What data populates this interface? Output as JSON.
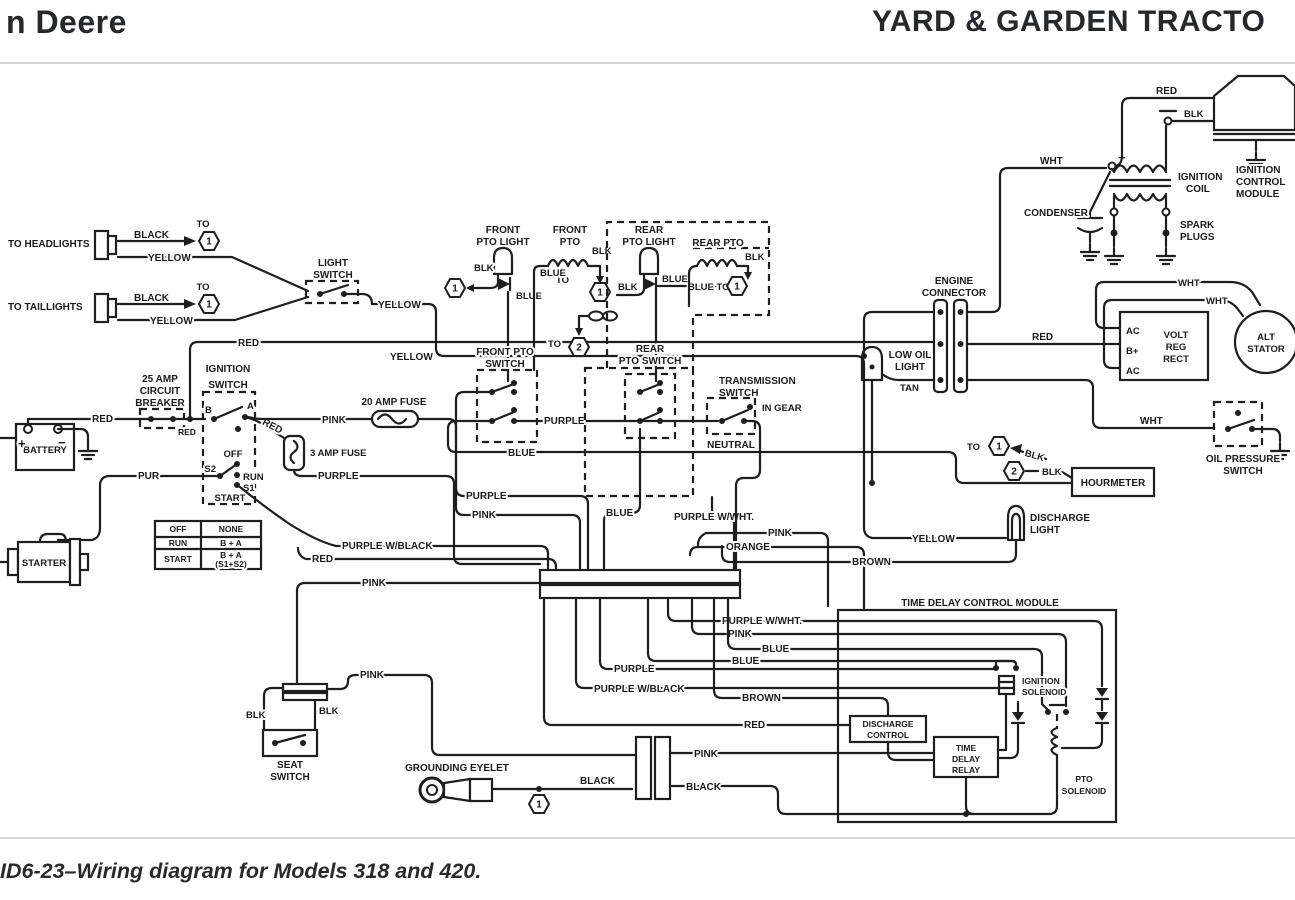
{
  "header": {
    "brand": "n Deere",
    "title": "YARD & GARDEN TRACTO"
  },
  "caption": "ID6-23–Wiring diagram for Models 318 and 420.",
  "wire": {
    "red": "RED",
    "black": "BLACK",
    "blk": "BLK",
    "yellow": "YELLOW",
    "blue": "BLUE",
    "purple": "PURPLE",
    "pink": "PINK",
    "pur": "PUR",
    "orange": "ORANGE",
    "brown": "BROWN",
    "tan": "TAN",
    "wht": "WHT",
    "purple_w_wht": "PURPLE W/WHT.",
    "purple_w_black": "PURPLE W/BLACK",
    "blue_to": "BLUE TO",
    "to": "TO"
  },
  "ref": {
    "one": "1",
    "two": "2"
  },
  "components": {
    "headlights": "TO HEADLIGHTS",
    "taillights": "TO TAILLIGHTS",
    "light_switch": [
      "LIGHT",
      "SWITCH"
    ],
    "front_pto_light": [
      "FRONT",
      "PTO LIGHT"
    ],
    "front_pto": [
      "FRONT",
      "PTO"
    ],
    "rear_pto_light": [
      "REAR",
      "PTO LIGHT"
    ],
    "rear_pto": "REAR PTO",
    "front_pto_switch": [
      "FRONT PTO",
      "SWITCH"
    ],
    "rear_pto_switch": [
      "REAR",
      "PTO SWITCH"
    ],
    "transmission_switch": [
      "TRANSMISSION",
      "SWITCH"
    ],
    "in_gear": "IN GEAR",
    "neutral": "NEUTRAL",
    "circ_breaker": [
      "25 AMP",
      "CIRCUIT",
      "BREAKER"
    ],
    "ignition_switch": [
      "IGNITION",
      "SWITCH"
    ],
    "fuse_20": "20 AMP FUSE",
    "fuse_3": "3 AMP FUSE",
    "battery": "BATTERY",
    "starter": "STARTER",
    "engine_connector": [
      "ENGINE",
      "CONNECTOR"
    ],
    "low_oil_light": [
      "LOW OIL",
      "LIGHT"
    ],
    "volt_reg": [
      "VOLT",
      "REG",
      "RECT"
    ],
    "alt_stator": [
      "ALT",
      "STATOR"
    ],
    "ignition_coil": [
      "IGNITION",
      "COIL"
    ],
    "condenser": "CONDENSER",
    "spark_plugs": [
      "SPARK",
      "PLUGS"
    ],
    "ignition_control_module": [
      "IGNITION",
      "CONTROL",
      "MODULE"
    ],
    "hourmeter": "HOURMETER",
    "oil_pressure_switch": [
      "OIL PRESSURE",
      "SWITCH"
    ],
    "discharge_light": [
      "DISCHARGE",
      "LIGHT"
    ],
    "time_delay_control_module": "TIME DELAY CONTROL MODULE",
    "ignition_solenoid": [
      "IGNITION",
      "SOLENOID"
    ],
    "time_delay_relay": [
      "TIME",
      "DELAY",
      "RELAY"
    ],
    "pto_solenoid": [
      "PTO",
      "SOLENOID"
    ],
    "discharge_control": [
      "DISCHARGE",
      "CONTROL"
    ],
    "seat_switch": [
      "SEAT",
      "SWITCH"
    ],
    "grounding_eyelet": "GROUNDING EYELET"
  },
  "regulator_terminals": {
    "ac": "AC",
    "bplus": "B+"
  },
  "ignition_terminals": {
    "b": "B",
    "a": "A",
    "s2": "S2",
    "s1": "S1",
    "off": "OFF",
    "run": "RUN",
    "start": "START"
  },
  "plus": "+",
  "minus": "−",
  "switch_table": {
    "rows": [
      [
        "OFF",
        "NONE"
      ],
      [
        "RUN",
        "B + A"
      ],
      [
        "START",
        "B + A",
        "(S1+S2)"
      ]
    ]
  }
}
